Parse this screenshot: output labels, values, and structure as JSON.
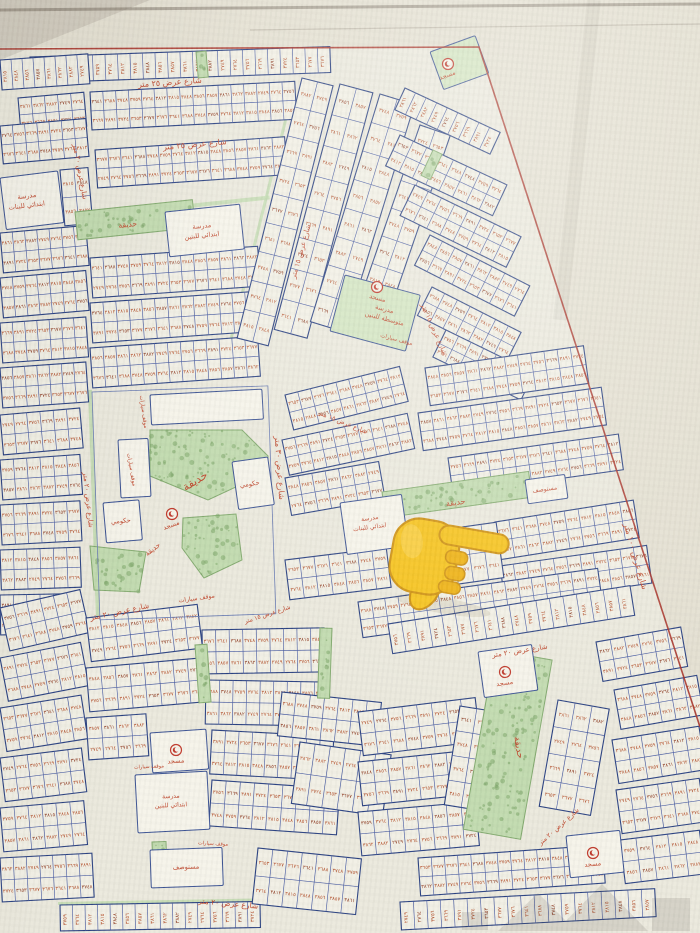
{
  "palette": {
    "paper_outside": "#e4e0d2",
    "paper_map": "#ebe9dd",
    "block_fill": "#f2f0e5",
    "block_border": "#2c4383",
    "cell_line": "#4a5da3",
    "number_red": "#b5532f",
    "number_dark": "#8e3b22",
    "green_fill": "#c2dbb0",
    "green_dot": "#7fa86c",
    "green_stroke": "#84ab70",
    "label_red": "#c04a30",
    "boundary_red": "#a8352b",
    "facility_fill": "#f6f4ea",
    "facility_green": "#d3e5c2",
    "mosque_red": "#c0392b",
    "watermark_gray": "#53504a",
    "hand_yellow": "#f6c31d",
    "hand_shade": "#efb214",
    "hand_outline": "#cf9212"
  },
  "labels": {
    "street_25": "شارع عرض ٢٥ متر",
    "street_20": "شارع عرض ٢٠ متر",
    "street_15": "شارع عرض ١٥ متر",
    "street_30": "شارع عرض ٣٠ متر",
    "street_100": "شارع عرض ١٠٠ متر",
    "garden": "حديقة",
    "mosque": "مسجد",
    "government": "حكومي",
    "clinic": "مستوصف",
    "parking": "موقف سيارات",
    "school_line1": "مدرسة",
    "school_boys_elem": "ابتدائي للبنين",
    "school_girls_elem": "ابتدائي للبنات",
    "school_boys_middle": "متوسطة للبنين"
  },
  "plot_numbers_sample": [
    "٣٦٧٧",
    "٣٦٧٦",
    "٣٦٤١",
    "٣٦٨٨",
    "٣٧٤٨",
    "٣٧٥٩",
    "٣٧٦٤",
    "٣٨١٢",
    "٣٨١٥",
    "٣٨٤٨",
    "٣٨٥٦",
    "٣٨٥٧",
    "٣٨٦١",
    "٣٨٦٢",
    "٣٨٨٢",
    "٢٧٤٩",
    "٢٧٦٤",
    "٣٧٥٦",
    "٣٦٦٩",
    "٣٨٩١",
    "٣٧٢٤",
    "٣٦٥٣"
  ],
  "map": {
    "boundary": {
      "top": [
        [
          0,
          49
        ],
        [
          479,
          47
        ]
      ],
      "diagonal": [
        [
          479,
          47
        ],
        [
          700,
          727
        ]
      ]
    },
    "blocks": [
      [
        30,
        57,
        300,
        26,
        -2,
        24,
        1
      ],
      [
        90,
        92,
        205,
        38,
        -3,
        16,
        2
      ],
      [
        18,
        98,
        66,
        34,
        -5,
        5,
        2
      ],
      [
        95,
        150,
        190,
        38,
        -4,
        15,
        2
      ],
      [
        0,
        60,
        88,
        30,
        -4,
        8,
        1
      ],
      [
        0,
        126,
        86,
        38,
        -5,
        7,
        2
      ],
      [
        60,
        170,
        28,
        56,
        -5,
        2,
        2
      ],
      [
        0,
        233,
        86,
        40,
        -5,
        7,
        2
      ],
      [
        0,
        278,
        86,
        40,
        -5,
        7,
        2
      ],
      [
        0,
        323,
        86,
        40,
        -4,
        7,
        2
      ],
      [
        0,
        368,
        86,
        40,
        -4,
        7,
        2
      ],
      [
        90,
        258,
        168,
        40,
        -4,
        13,
        2
      ],
      [
        90,
        303,
        168,
        40,
        -4,
        13,
        2
      ],
      [
        90,
        348,
        168,
        40,
        -4,
        13,
        2
      ],
      [
        302,
        78,
        32,
        268,
        14,
        2,
        9
      ],
      [
        340,
        84,
        34,
        254,
        15,
        2,
        8
      ],
      [
        380,
        94,
        36,
        238,
        17,
        2,
        8
      ],
      [
        420,
        125,
        32,
        205,
        19,
        2,
        7
      ],
      [
        405,
        88,
        105,
        24,
        25,
        9,
        1
      ],
      [
        400,
        135,
        118,
        34,
        25,
        8,
        2
      ],
      [
        415,
        185,
        118,
        34,
        26,
        8,
        2
      ],
      [
        430,
        235,
        112,
        34,
        27,
        8,
        2
      ],
      [
        432,
        287,
        100,
        32,
        27,
        7,
        2
      ],
      [
        446,
        330,
        98,
        30,
        26,
        7,
        2
      ],
      [
        425,
        368,
        160,
        38,
        -8,
        12,
        2
      ],
      [
        418,
        413,
        185,
        38,
        -8,
        14,
        2
      ],
      [
        448,
        458,
        172,
        36,
        -8,
        13,
        2
      ],
      [
        285,
        395,
        118,
        36,
        -14,
        9,
        2
      ],
      [
        282,
        440,
        128,
        36,
        -12,
        10,
        2
      ],
      [
        0,
        415,
        80,
        40,
        -5,
        6,
        2
      ],
      [
        0,
        460,
        80,
        40,
        -4,
        6,
        2
      ],
      [
        0,
        505,
        80,
        40,
        -3,
        6,
        2
      ],
      [
        0,
        550,
        80,
        40,
        -2,
        6,
        2
      ],
      [
        0,
        595,
        80,
        40,
        -1,
        6,
        2
      ],
      [
        285,
        478,
        95,
        38,
        -10,
        7,
        2
      ],
      [
        495,
        522,
        140,
        38,
        -9,
        10,
        2
      ],
      [
        285,
        560,
        102,
        40,
        -7,
        7,
        2
      ],
      [
        500,
        566,
        148,
        38,
        -8,
        11,
        2
      ],
      [
        405,
        535,
        92,
        56,
        -8,
        6,
        2
      ],
      [
        358,
        602,
        242,
        36,
        -8,
        18,
        2
      ],
      [
        0,
        608,
        82,
        44,
        -13,
        6,
        2
      ],
      [
        86,
        618,
        112,
        44,
        -7,
        8,
        2
      ],
      [
        202,
        630,
        122,
        44,
        -1,
        9,
        2
      ],
      [
        0,
        658,
        82,
        44,
        -11,
        6,
        2
      ],
      [
        86,
        668,
        116,
        44,
        -5,
        8,
        2
      ],
      [
        206,
        680,
        122,
        44,
        1,
        9,
        2
      ],
      [
        0,
        708,
        82,
        44,
        -9,
        6,
        2
      ],
      [
        86,
        718,
        60,
        42,
        -4,
        4,
        2
      ],
      [
        212,
        730,
        122,
        44,
        3,
        9,
        2
      ],
      [
        0,
        758,
        82,
        44,
        -7,
        6,
        2
      ],
      [
        0,
        808,
        84,
        44,
        -5,
        6,
        2
      ],
      [
        212,
        780,
        128,
        46,
        4,
        9,
        2
      ],
      [
        0,
        858,
        92,
        44,
        -3,
        7,
        2
      ],
      [
        60,
        905,
        200,
        26,
        -1,
        16,
        1
      ],
      [
        258,
        848,
        104,
        56,
        6,
        7,
        2
      ],
      [
        300,
        742,
        92,
        62,
        8,
        6,
        2
      ],
      [
        282,
        692,
        100,
        44,
        6,
        7,
        2
      ],
      [
        388,
        624,
        245,
        30,
        -9,
        18,
        1
      ],
      [
        596,
        642,
        86,
        40,
        -10,
        6,
        2
      ],
      [
        614,
        690,
        84,
        40,
        -10,
        6,
        2
      ],
      [
        358,
        712,
        118,
        44,
        -7,
        8,
        2
      ],
      [
        358,
        762,
        118,
        44,
        -6,
        8,
        2
      ],
      [
        612,
        740,
        88,
        44,
        -9,
        6,
        2
      ],
      [
        616,
        790,
        84,
        44,
        -8,
        6,
        2
      ],
      [
        358,
        812,
        118,
        44,
        -5,
        8,
        2
      ],
      [
        418,
        858,
        185,
        38,
        -4,
        14,
        2
      ],
      [
        620,
        840,
        80,
        44,
        -7,
        5,
        2
      ],
      [
        400,
        902,
        255,
        28,
        -3,
        19,
        1
      ],
      [
        558,
        700,
        52,
        108,
        10,
        3,
        4
      ],
      [
        460,
        706,
        34,
        100,
        9,
        2,
        4
      ]
    ],
    "parks_rect": [
      [
        75,
        212,
        118,
        28,
        -6
      ],
      [
        382,
        492,
        148,
        26,
        -8
      ],
      [
        495,
        650,
        58,
        182,
        10
      ],
      [
        196,
        52,
        10,
        26,
        -5
      ],
      [
        433,
        150,
        10,
        28,
        25
      ],
      [
        320,
        628,
        12,
        70,
        2
      ],
      [
        195,
        645,
        12,
        58,
        -4
      ],
      [
        152,
        842,
        14,
        26,
        -2
      ]
    ],
    "parks_poly": [
      [
        [
          150,
          430
        ],
        [
          242,
          430
        ],
        [
          268,
          456
        ],
        [
          268,
          472
        ],
        [
          208,
          500
        ],
        [
          150,
          476
        ]
      ],
      [
        [
          183,
          518
        ],
        [
          236,
          514
        ],
        [
          242,
          560
        ],
        [
          204,
          578
        ],
        [
          182,
          548
        ]
      ],
      [
        [
          90,
          546
        ],
        [
          146,
          552
        ],
        [
          139,
          592
        ],
        [
          94,
          590
        ]
      ]
    ],
    "green_edges": [
      [
        88,
        390,
        4,
        232,
        -2
      ],
      [
        292,
        88,
        3,
        262,
        14
      ],
      [
        150,
        208,
        120,
        4,
        -6
      ],
      [
        58,
        902,
        202,
        3,
        -1
      ]
    ],
    "facilities": [
      [
        0,
        178,
        58,
        52,
        -7,
        "w"
      ],
      [
        165,
        212,
        75,
        45,
        -6,
        "w"
      ],
      [
        345,
        275,
        78,
        58,
        15,
        "g"
      ],
      [
        340,
        503,
        62,
        52,
        -8,
        "w"
      ],
      [
        135,
        775,
        72,
        58,
        -3,
        "w"
      ],
      [
        150,
        850,
        72,
        38,
        -2,
        "w"
      ],
      [
        525,
        480,
        40,
        24,
        -8,
        "w"
      ],
      [
        430,
        52,
        48,
        40,
        -20,
        "g"
      ],
      [
        150,
        733,
        56,
        40,
        -4,
        "w"
      ],
      [
        478,
        652,
        54,
        46,
        -8,
        "w"
      ],
      [
        566,
        836,
        54,
        42,
        -6,
        "w"
      ],
      [
        103,
        503,
        36,
        40,
        -5,
        "w"
      ],
      [
        232,
        462,
        36,
        48,
        -8,
        "w"
      ],
      [
        150,
        395,
        112,
        30,
        -3,
        "w"
      ],
      [
        118,
        440,
        30,
        58,
        -3,
        "w"
      ]
    ],
    "mosques": [
      [
        448,
        64,
        -20
      ],
      [
        377,
        287,
        15
      ],
      [
        172,
        514,
        -20
      ],
      [
        176,
        750,
        -4
      ],
      [
        505,
        672,
        -8
      ],
      [
        593,
        853,
        -6
      ]
    ],
    "street_labels": [
      [
        "street_25",
        170,
        85,
        -4,
        8
      ],
      [
        "street_25",
        195,
        147,
        -5,
        8
      ],
      [
        "street_20",
        78,
        172,
        80,
        7
      ],
      [
        "street_20",
        86,
        500,
        84,
        7
      ],
      [
        "parking",
        130,
        470,
        80,
        5.5
      ],
      [
        "street_30",
        277,
        468,
        86,
        8
      ],
      [
        "street_100",
        633,
        557,
        74,
        8
      ],
      [
        "street_20",
        120,
        614,
        -12,
        7.5
      ],
      [
        "street_20",
        228,
        906,
        5,
        7.5
      ],
      [
        "street_20",
        520,
        653,
        -9,
        7
      ],
      [
        "street_15",
        303,
        252,
        -74,
        7
      ],
      [
        "street_15",
        432,
        330,
        66,
        7
      ],
      [
        "street_15",
        342,
        424,
        22,
        6.5
      ],
      [
        "street_20",
        560,
        828,
        -42,
        6.5
      ],
      [
        "street_15",
        268,
        616,
        -18,
        6
      ]
    ],
    "facility_labels": [
      {
        "x": 27,
        "y": 198,
        "r": -7,
        "s": 6.5,
        "lines": [
          "school_line1",
          "school_girls_elem"
        ]
      },
      {
        "x": 202,
        "y": 228,
        "r": -6,
        "s": 6.5,
        "lines": [
          "school_line1",
          "school_boys_elem"
        ]
      },
      {
        "x": 384,
        "y": 311,
        "r": 15,
        "s": 6.5,
        "lines": [
          "school_line1",
          "school_boys_middle"
        ]
      },
      {
        "x": 370,
        "y": 520,
        "r": -8,
        "s": 6,
        "lines": [
          "school_line1",
          "school_girls_elem"
        ]
      },
      {
        "x": 171,
        "y": 798,
        "r": -3,
        "s": 6,
        "lines": [
          "school_line1",
          "school_boys_elem"
        ]
      },
      {
        "x": 186,
        "y": 869,
        "r": -2,
        "s": 6.5,
        "lines": [
          "clinic"
        ]
      },
      {
        "x": 545,
        "y": 491,
        "r": -8,
        "s": 6,
        "lines": [
          "clinic"
        ]
      },
      {
        "x": 121,
        "y": 523,
        "r": -5,
        "s": 6.5,
        "lines": [
          "government"
        ]
      },
      {
        "x": 250,
        "y": 486,
        "r": -8,
        "s": 6.5,
        "lines": [
          "government"
        ]
      }
    ],
    "garden_labels": [
      [
        128,
        227,
        -6,
        7.5
      ],
      [
        197,
        484,
        -32,
        11
      ],
      [
        154,
        551,
        -38,
        7
      ],
      [
        456,
        505,
        -8,
        8
      ],
      [
        516,
        748,
        80,
        9
      ]
    ],
    "parking_labels": [
      [
        142,
        412,
        82,
        5.5
      ],
      [
        197,
        600,
        -8,
        6
      ],
      [
        396,
        341,
        15,
        5.5
      ],
      [
        149,
        768,
        -3,
        5
      ],
      [
        213,
        845,
        3,
        5
      ]
    ],
    "outlines": [
      [
        92,
        392,
        176,
        228,
        -2
      ]
    ]
  },
  "pointer": {
    "cx": 450,
    "cy": 555,
    "rotation": 10
  },
  "watermark": {
    "opacity": 0.14
  }
}
